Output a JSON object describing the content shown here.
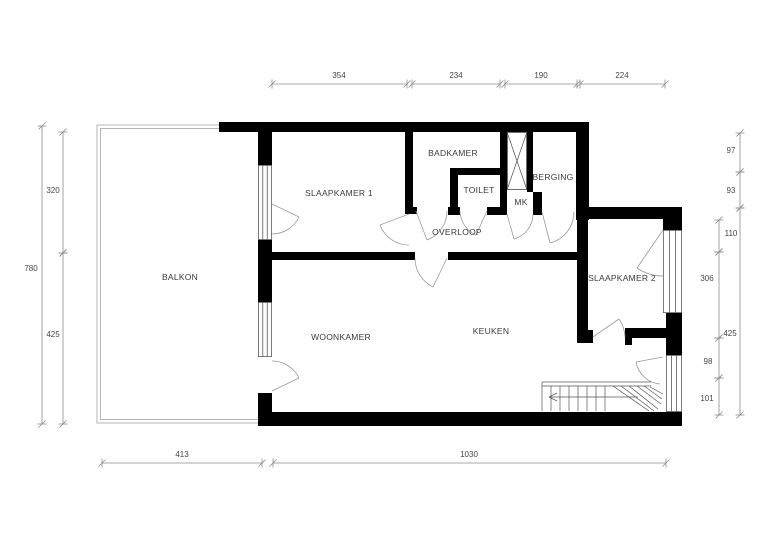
{
  "drawing": {
    "type": "floor-plan",
    "colors": {
      "wall": "#000000",
      "thin": "#4a4a4a",
      "window": "#5a5a5a",
      "door": "#9a9a9a",
      "stairs": "#555555",
      "balcony": "#b5b5b5",
      "dim_line": "#8c8c8c",
      "dim_text": "#454545",
      "label_text": "#3a3a3a",
      "background": "#ffffff"
    },
    "rooms": [
      {
        "name": "BALKON",
        "x": 180,
        "y": 280
      },
      {
        "name": "SLAAPKAMER 1",
        "x": 339,
        "y": 196
      },
      {
        "name": "BADKAMER",
        "x": 453,
        "y": 156
      },
      {
        "name": "TOILET",
        "x": 479,
        "y": 193
      },
      {
        "name": "BERGING",
        "x": 553,
        "y": 180
      },
      {
        "name": "MK",
        "x": 521,
        "y": 205
      },
      {
        "name": "OVERLOOP",
        "x": 457,
        "y": 235
      },
      {
        "name": "WOONKAMER",
        "x": 341,
        "y": 340
      },
      {
        "name": "KEUKEN",
        "x": 491,
        "y": 334
      },
      {
        "name": "SLAAPKAMER 2",
        "x": 622,
        "y": 281
      }
    ],
    "walls": [
      [
        219,
        122,
        369,
        10
      ],
      [
        576,
        122,
        13,
        98
      ],
      [
        577,
        207,
        105,
        12
      ],
      [
        663,
        207,
        19,
        23
      ],
      [
        666,
        313,
        16,
        42
      ],
      [
        666,
        412,
        16,
        14
      ],
      [
        258,
        412,
        424,
        14
      ],
      [
        258,
        122,
        14,
        43
      ],
      [
        258,
        240,
        14,
        62
      ],
      [
        258,
        393,
        14,
        33
      ],
      [
        405,
        132,
        8,
        81
      ],
      [
        405,
        207,
        12,
        7
      ],
      [
        266,
        252,
        149,
        8
      ],
      [
        448,
        252,
        129,
        8
      ],
      [
        577,
        207,
        11,
        136
      ],
      [
        450,
        168,
        8,
        47
      ],
      [
        450,
        168,
        57,
        7
      ],
      [
        448,
        207,
        12,
        8
      ],
      [
        487,
        207,
        13,
        8
      ],
      [
        500,
        130,
        7,
        85
      ],
      [
        527,
        130,
        6,
        62
      ],
      [
        533,
        192,
        9,
        23
      ],
      [
        577,
        330,
        16,
        13
      ],
      [
        625,
        328,
        7,
        17
      ],
      [
        632,
        328,
        35,
        10
      ]
    ],
    "windows": [
      {
        "x": 258,
        "y": 165,
        "w": 14,
        "h": 75
      },
      {
        "x": 258,
        "y": 302,
        "w": 14,
        "h": 55
      },
      {
        "x": 663,
        "y": 230,
        "w": 19,
        "h": 83
      },
      {
        "x": 666,
        "y": 355,
        "w": 16,
        "h": 57
      }
    ],
    "balcony": {
      "outer": "M 219 125 H 97 V 423 H 258",
      "inner": "M 219 128.5 H 100.5 V 419.5 H 258"
    },
    "shaft": {
      "x": 507,
      "y": 132,
      "w": 20,
      "h": 58
    },
    "doors": [
      {
        "arc": "M 299 217 A 30 30 0 0 1 272 234",
        "leaf": [
          272,
          204,
          299,
          217
        ]
      },
      {
        "arc": "M 272 361 A 30 30 0 0 1 299 378",
        "leaf": [
          272,
          391,
          299,
          378
        ]
      },
      {
        "arc": "M 409 245 A 31 31 0 0 1 380 225",
        "leaf": [
          409,
          214,
          380,
          225
        ]
      },
      {
        "arc": "M 447 211 A 31 31 0 0 1 427 240",
        "leaf": [
          416,
          211,
          427,
          240
        ]
      },
      {
        "arc": "M 533 214 A 26 26 0 0 1 514 239",
        "leaf": [
          507,
          214,
          514,
          239
        ]
      },
      {
        "arc": "M 460 211 A 27 27 0 0 0 476 235",
        "leaf": [
          487,
          211,
          476,
          235
        ]
      },
      {
        "arc": "M 574 212 A 32 32 0 0 1 550 243",
        "leaf": [
          542,
          212,
          550,
          243
        ]
      },
      {
        "arc": "M 415 258 A 32 32 0 0 0 433 287",
        "leaf": [
          447,
          258,
          433,
          287
        ]
      },
      {
        "arc": "M 625 337 A 32 32 0 0 0 619 319",
        "leaf": [
          593,
          337,
          619,
          319
        ]
      },
      {
        "arc": "M 637 268 A 46 46 0 0 0 663 276",
        "leaf": [
          663,
          230,
          637,
          268
        ]
      },
      {
        "arc": "M 636 362 A 27 27 0 0 0 660 384",
        "leaf": [
          663,
          357,
          636,
          362
        ]
      }
    ],
    "stairs": {
      "segments": [
        [
          542,
          382,
          651,
          382
        ],
        [
          542,
          386,
          651,
          386
        ],
        [
          542,
          382,
          542,
          411
        ],
        [
          551,
          386,
          551,
          411
        ],
        [
          560,
          386,
          560,
          411
        ],
        [
          569,
          386,
          569,
          411
        ],
        [
          578,
          386,
          578,
          411
        ],
        [
          587,
          386,
          587,
          411
        ],
        [
          596,
          386,
          596,
          411
        ],
        [
          605,
          386,
          605,
          411
        ],
        [
          613,
          386,
          649,
          411
        ],
        [
          621,
          386,
          654,
          411
        ],
        [
          629,
          386,
          658,
          409
        ],
        [
          637,
          386,
          661,
          404
        ],
        [
          644,
          386,
          662,
          399
        ],
        [
          650,
          387,
          663,
          394
        ],
        [
          638,
          397,
          549,
          397
        ],
        [
          549,
          397,
          557,
          393
        ],
        [
          549,
          397,
          557,
          401
        ]
      ]
    },
    "dims": [
      {
        "o": "h",
        "c": 84,
        "a1": 272,
        "a2": 407,
        "label": "354",
        "lx": 339,
        "ly": 78
      },
      {
        "o": "h",
        "c": 84,
        "a1": 412,
        "a2": 500,
        "label": "234",
        "lx": 456,
        "ly": 78
      },
      {
        "o": "h",
        "c": 84,
        "a1": 505,
        "a2": 577,
        "label": "190",
        "lx": 541,
        "ly": 78
      },
      {
        "o": "h",
        "c": 84,
        "a1": 580,
        "a2": 665,
        "label": "224",
        "lx": 622,
        "ly": 78
      },
      {
        "o": "h",
        "c": 463,
        "a1": 102,
        "a2": 262,
        "label": "413",
        "lx": 182,
        "ly": 457
      },
      {
        "o": "h",
        "c": 463,
        "a1": 273,
        "a2": 666,
        "label": "1030",
        "lx": 469,
        "ly": 457
      },
      {
        "o": "v",
        "c": 42,
        "a1": 126,
        "a2": 424,
        "label": "780",
        "lx": 31,
        "ly": 271
      },
      {
        "o": "v",
        "c": 63,
        "a1": 132,
        "a2": 253,
        "label": "320",
        "lx": 53,
        "ly": 193
      },
      {
        "o": "v",
        "c": 63,
        "a1": 253,
        "a2": 424,
        "label": "425",
        "lx": 53,
        "ly": 337
      },
      {
        "o": "v",
        "c": 740,
        "a1": 133,
        "a2": 172,
        "label": "97",
        "lx": 731,
        "ly": 153
      },
      {
        "o": "v",
        "c": 740,
        "a1": 172,
        "a2": 208,
        "label": "93",
        "lx": 731,
        "ly": 193
      },
      {
        "o": "v",
        "c": 740,
        "a1": 208,
        "a2": 415,
        "label": "425",
        "lx": 730,
        "ly": 336
      },
      {
        "o": "v",
        "c": 719,
        "a1": 220,
        "a2": 252,
        "label": "110",
        "lx": 731,
        "ly": 236
      },
      {
        "o": "v",
        "c": 719,
        "a1": 252,
        "a2": 338,
        "label": "306",
        "lx": 707,
        "ly": 281
      },
      {
        "o": "v",
        "c": 719,
        "a1": 338,
        "a2": 378,
        "label": "98",
        "lx": 708,
        "ly": 364
      },
      {
        "o": "v",
        "c": 719,
        "a1": 378,
        "a2": 415,
        "label": "101",
        "lx": 707,
        "ly": 401
      }
    ]
  }
}
